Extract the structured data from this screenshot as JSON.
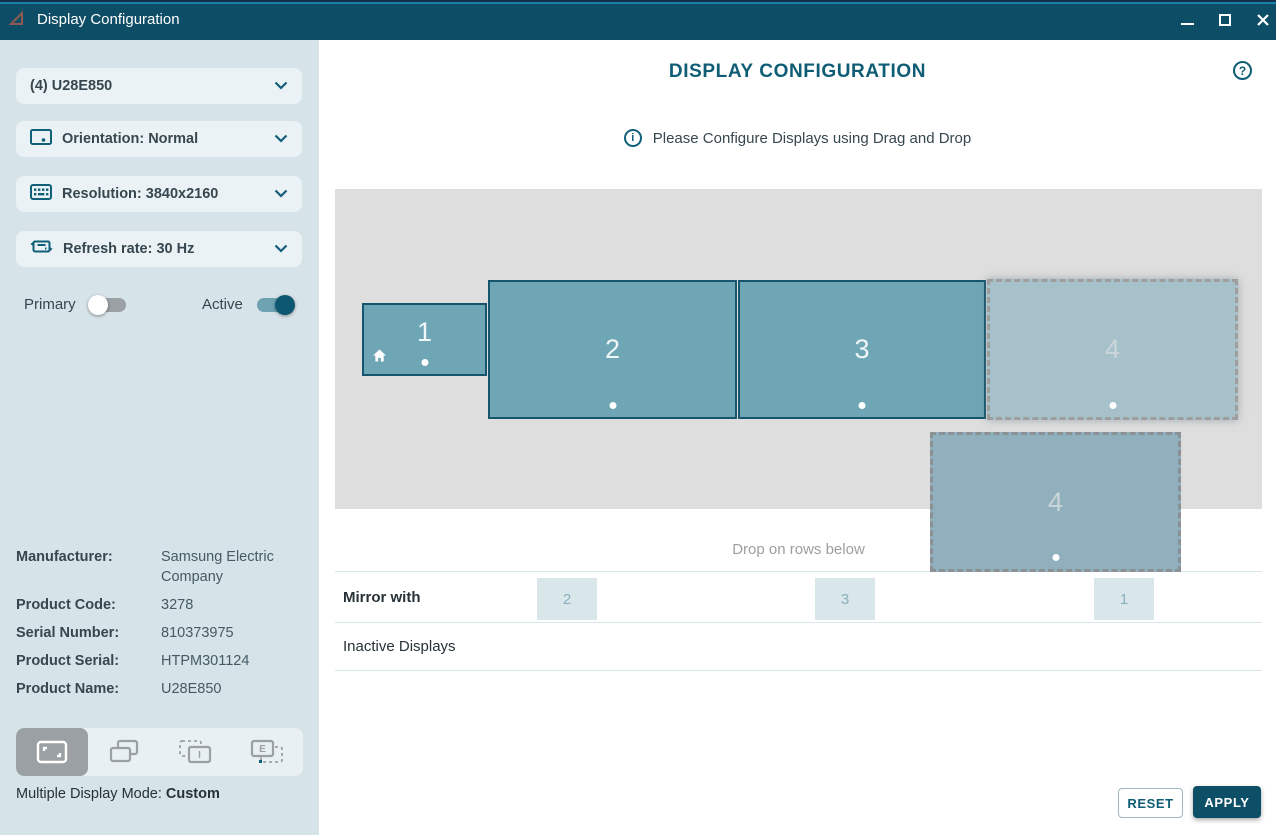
{
  "titlebar": {
    "title": "Display Configuration"
  },
  "sidebar": {
    "device_selector": {
      "label": "(4) U28E850"
    },
    "orientation_selector": {
      "label": "Orientation: Normal"
    },
    "resolution_selector": {
      "label": "Resolution: 3840x2160"
    },
    "refresh_selector": {
      "label": "Refresh rate: 30 Hz"
    },
    "toggles": {
      "primary_label": "Primary",
      "active_label": "Active",
      "primary_state": "off",
      "active_state": "on"
    },
    "info": [
      {
        "label": "Manufacturer:",
        "value": "Samsung Electric Company"
      },
      {
        "label": "Product Code:",
        "value": "3278"
      },
      {
        "label": "Serial Number:",
        "value": "810373975"
      },
      {
        "label": "Product Serial:",
        "value": "HTPM301124"
      },
      {
        "label": "Product Name:",
        "value": "U28E850"
      }
    ],
    "mode_label": "Multiple Display Mode: ",
    "mode_value": "Custom"
  },
  "main": {
    "title": "DISPLAY CONFIGURATION",
    "help_glyph": "?",
    "info_glyph": "i",
    "info_message": "Please Configure Displays using Drag and Drop",
    "displays": [
      {
        "label": "1",
        "state": "active-primary-home"
      },
      {
        "label": "2",
        "state": "active"
      },
      {
        "label": "3",
        "state": "active"
      },
      {
        "label": "4",
        "state": "ghost-placeholder"
      },
      {
        "label": "4",
        "state": "dragging"
      }
    ],
    "drop_hint": "Drop on rows below",
    "mirror_row": {
      "label": "Mirror with",
      "items": [
        "2",
        "3",
        "1"
      ]
    },
    "inactive_row": {
      "label": "Inactive Displays"
    },
    "buttons": {
      "reset": "RESET",
      "apply": "APPLY"
    }
  },
  "colors": {
    "titlebar": "#0d4d66",
    "titlebar_stripe": "#1b7fae",
    "accent_teal": "#0f5d75",
    "sidebar_bg": "#d6e3e8",
    "dropdown_bg": "#eaf2f5",
    "canvas_bg": "#dedede",
    "display_fill": "#6fa6b5",
    "display_border": "#15566e",
    "ghost_fill": "#a7c1cb",
    "chip_bg": "#d9e7ea",
    "apply_bg": "#0e4f68",
    "toggle_on_track": "#6fa3b2",
    "toggle_on_knob": "#0e5770"
  }
}
